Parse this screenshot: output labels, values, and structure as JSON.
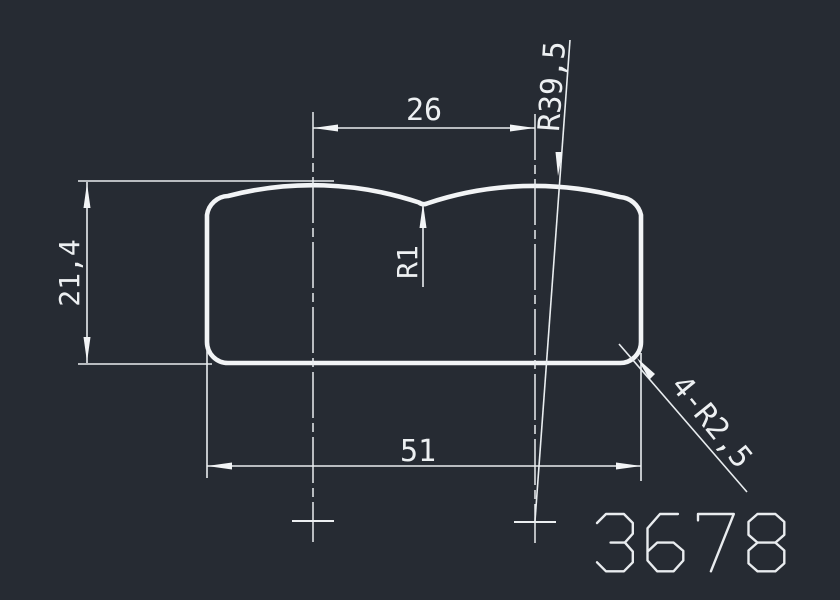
{
  "window": {
    "background_color": "#262b33",
    "line_color": "#f2f4f6"
  },
  "drawing": {
    "dimensions": {
      "top_width": {
        "label": "26"
      },
      "height": {
        "label": "21,4"
      },
      "center_fillet": {
        "label": "R1"
      },
      "top_radius": {
        "label": "R39,5"
      },
      "bottom_width": {
        "label": "51"
      },
      "corner_radius": {
        "label": "4-R2,5"
      }
    },
    "title_number": "3678"
  }
}
